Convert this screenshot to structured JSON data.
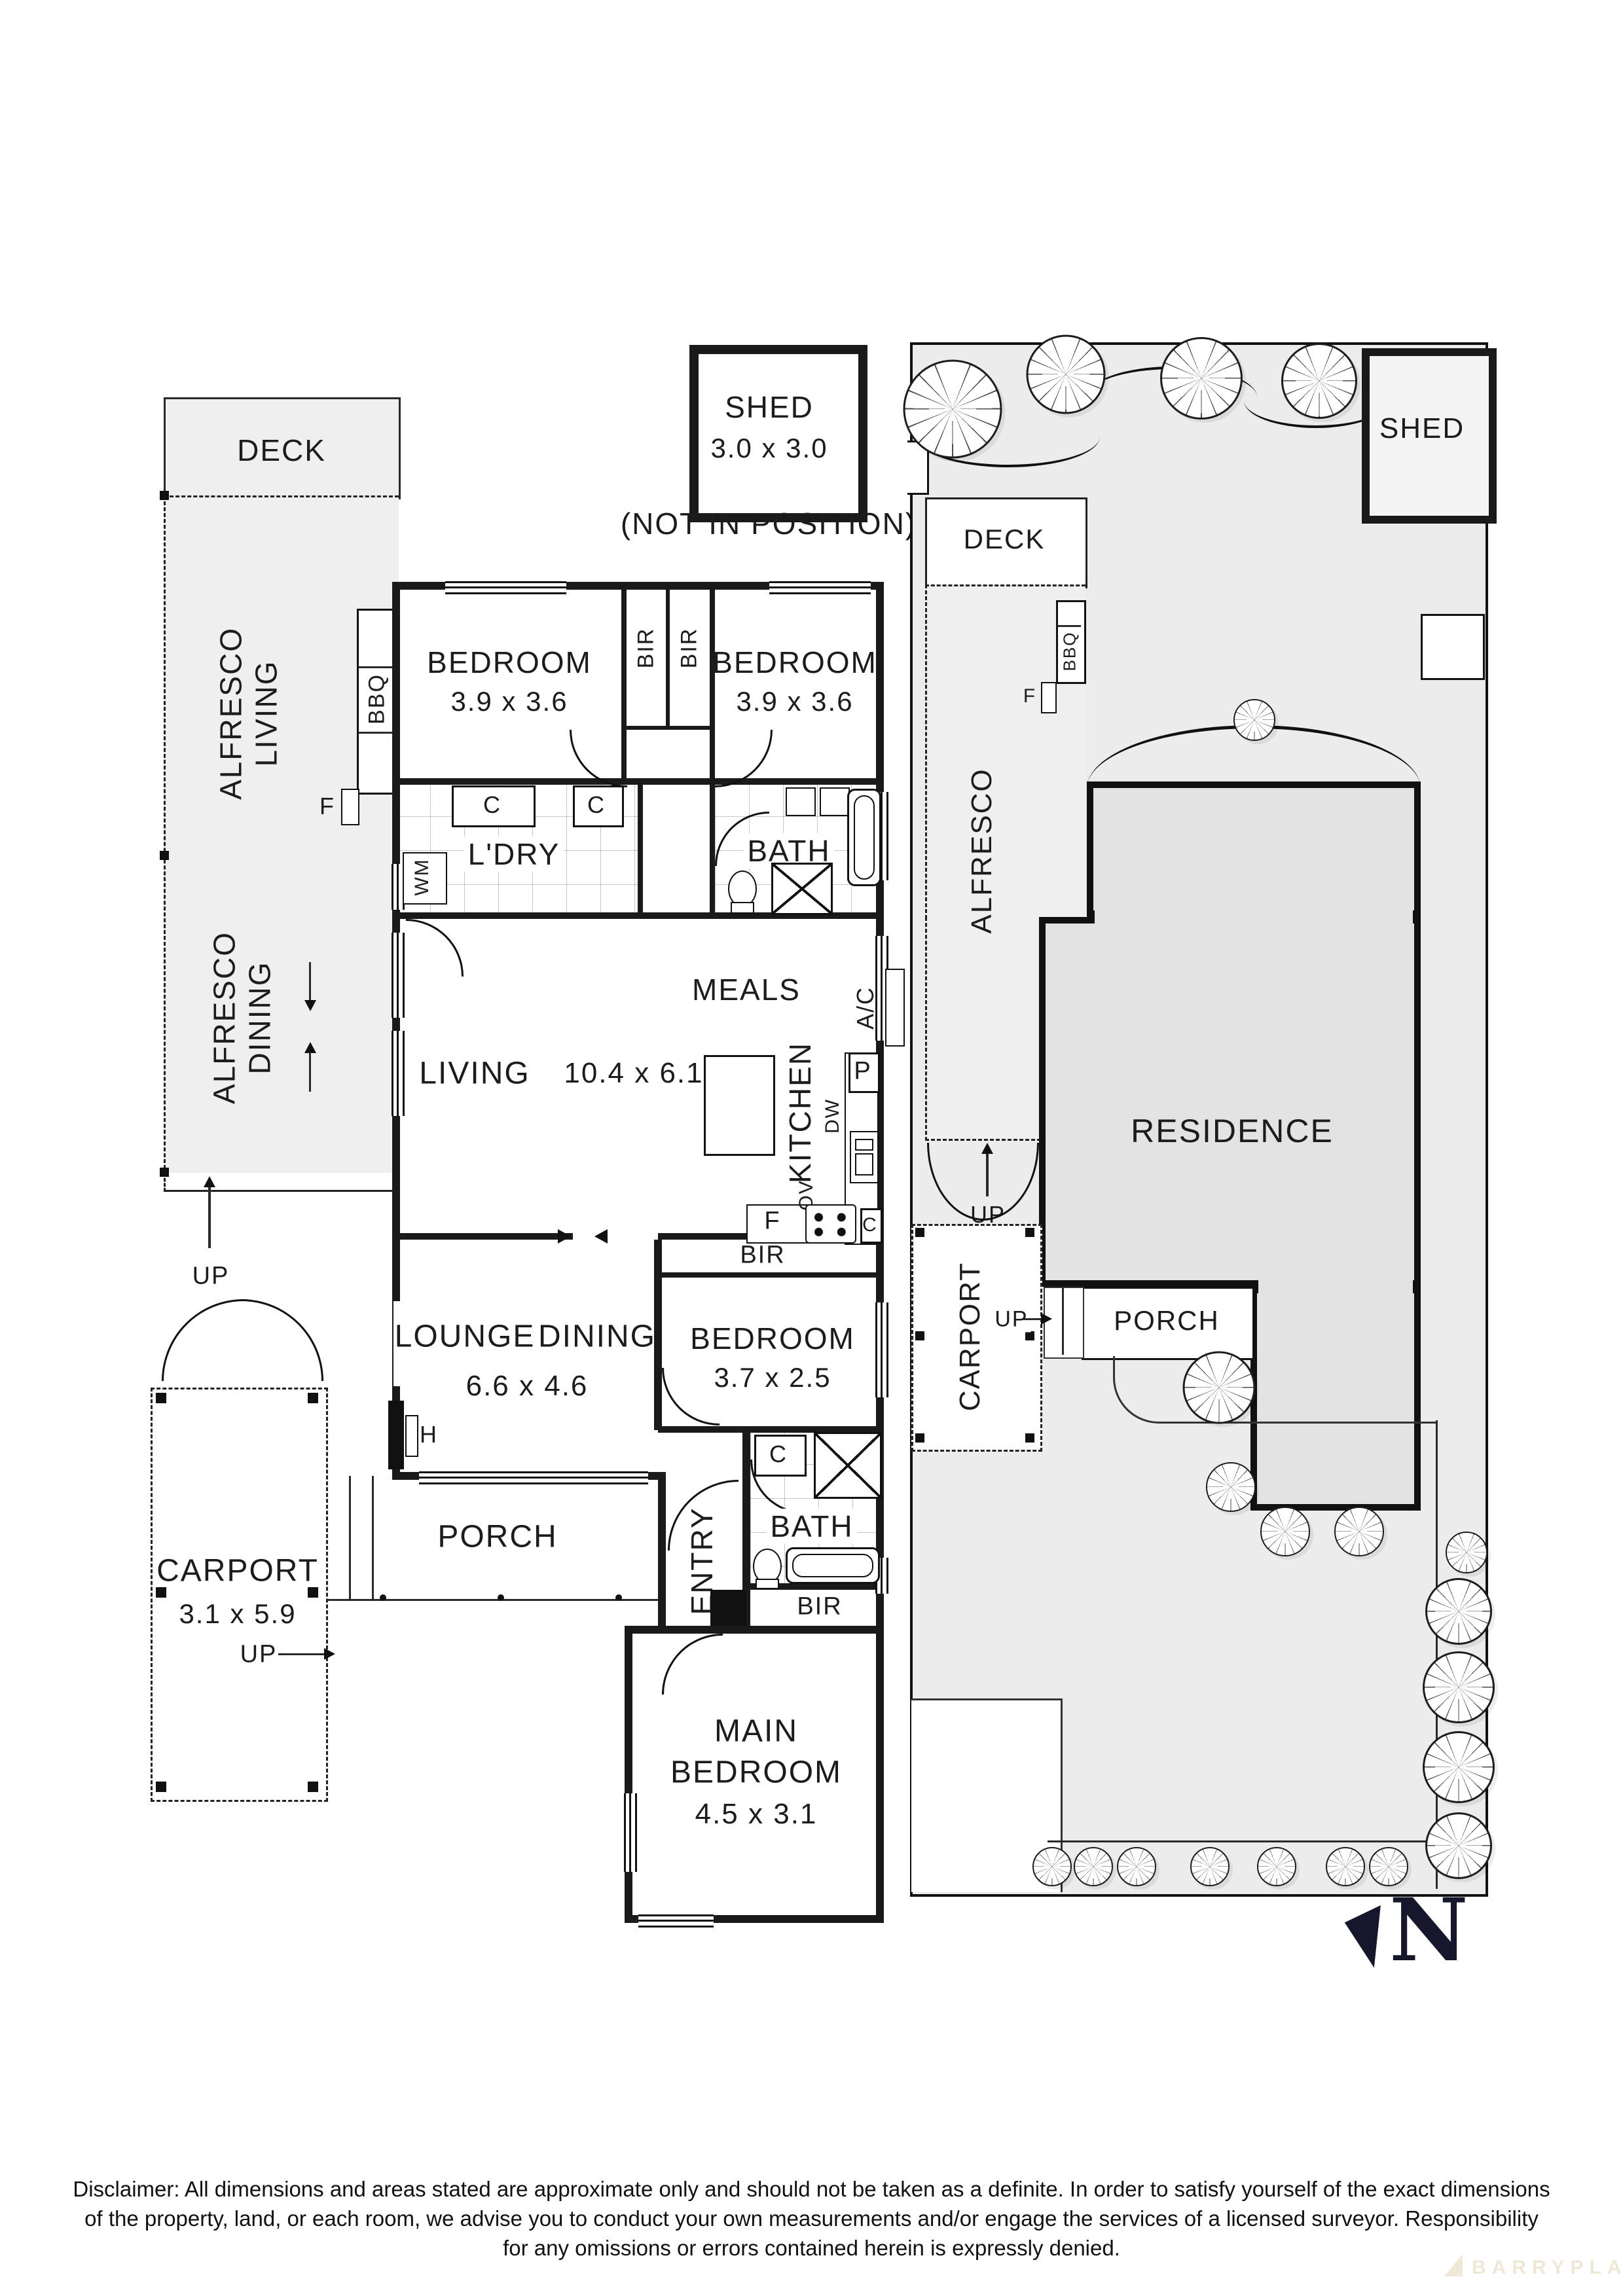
{
  "detached_shed": {
    "title": "SHED",
    "dims": "3.0 x 3.0",
    "note": "(NOT IN POSITION)"
  },
  "floorplan": {
    "deck": "DECK",
    "alfresco_living": {
      "l1": "ALFRESCO",
      "l2": "LIVING"
    },
    "alfresco_dining": {
      "l1": "ALFRESCO",
      "l2": "DINING"
    },
    "bbq": "BBQ",
    "bench_f": "F",
    "up_alfresco": "UP",
    "bedroom1": {
      "name": "BEDROOM",
      "dims": "3.9 x 3.6"
    },
    "bedroom2": {
      "name": "BEDROOM",
      "dims": "3.9 x 3.6"
    },
    "bir1": "BIR",
    "bir2": "BIR",
    "laundry": {
      "name": "L'DRY",
      "c1": "C",
      "c2": "C",
      "wm": "WM"
    },
    "bath1": {
      "name": "BATH"
    },
    "meals": "MEALS",
    "ac": "A/C",
    "living": {
      "name": "LIVING",
      "dims": "10.4 x 6.1"
    },
    "kitchen": {
      "name": "KITCHEN",
      "p": "P",
      "dw": "DW",
      "ov": "OV",
      "f": "F",
      "c": "C"
    },
    "bir3": "BIR",
    "bedroom3": {
      "name": "BEDROOM",
      "dims": "3.7 x 2.5"
    },
    "lounge": "LOUNGE",
    "dining": "DINING",
    "lounge_dims": "6.6 x 4.6",
    "h": "H",
    "porch": "PORCH",
    "carport": {
      "name": "CARPORT",
      "dims": "3.1 x 5.9",
      "up": "UP"
    },
    "entry": "ENTRY",
    "bath2": {
      "name": "BATH",
      "c": "C"
    },
    "bir4": "BIR",
    "main_bedroom": {
      "l1": "MAIN",
      "l2": "BEDROOM",
      "dims": "4.5 x 3.1"
    }
  },
  "siteplan": {
    "shed": "SHED",
    "deck": "DECK",
    "alfresco": "ALFRESCO",
    "bbq": "BBQ",
    "bench_f": "F",
    "up_alfresco": "UP",
    "carport": "CARPORT",
    "up_porch": "UP",
    "porch": "PORCH",
    "residence": "RESIDENCE"
  },
  "compass": {
    "letter": "N"
  },
  "disclaimer": {
    "line1": "Disclaimer: All dimensions and areas stated are approximate only and should not be taken as a definite. In order to satisfy yourself of the exact dimensions",
    "line2": "of the property, land, or each room, we advise you to conduct your own measurements and/or engage the services of a licensed surveyor. Responsibility",
    "line3": "for any omissions or errors contained herein is expressly denied."
  },
  "watermark": "BARRYPLANT",
  "colors": {
    "wall": "#1a1a1a",
    "outdoor": "#efefef",
    "site_ground": "#ececec",
    "residence": "#e3e3e3",
    "compass": "#16162c",
    "watermark": "#efe8d6"
  }
}
